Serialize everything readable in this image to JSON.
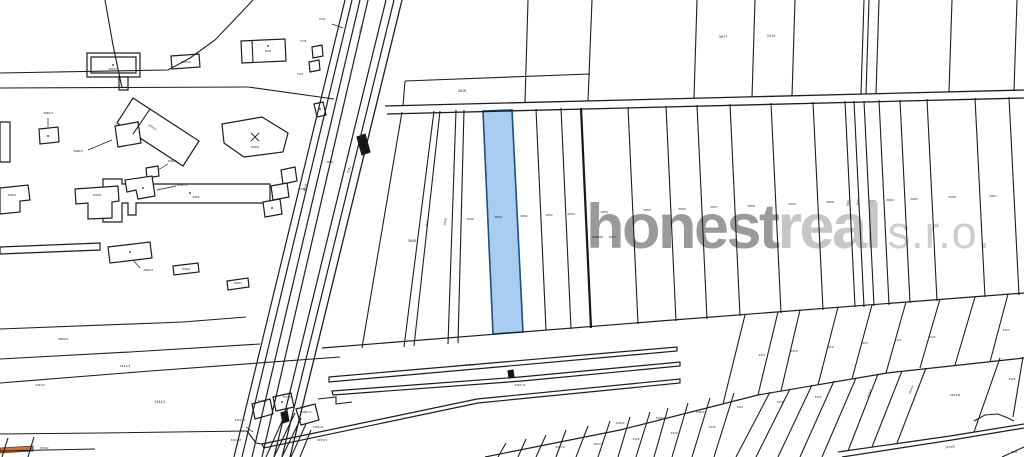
{
  "watermark": {
    "bold_text": "honest",
    "light_text": "real",
    "suffix_text": "s.r.o.",
    "bold_color": "#9a9a9a",
    "light_color": "#c6c6c6",
    "suffix_color": "#cdcdcd"
  },
  "map": {
    "width": 1024,
    "height": 457,
    "background": "#ffffff",
    "line_color": "#1d1d1d",
    "label_color": "#2a2a2a",
    "parcel_fill": "#ffffff",
    "highlight_blue_fill": "#a8cdf0",
    "highlight_blue_stroke": "#1f4e79",
    "highlight_orange_fill": "#c8733a",
    "highlight_orange_stroke": "#6b3410",
    "polygons": [
      {
        "p": "483,111 512,110 523,332 493,334",
        "f": "#a8cdf0",
        "s": "#1f4e79",
        "w": 1.6,
        "n": "highlighted-parcel-blue"
      },
      {
        "p": "0,448 33,446 33,451 0,453",
        "f": "#c8733a",
        "s": "#6b3410",
        "w": 0.8,
        "n": "highlighted-parcel-orange"
      },
      {
        "p": "329,377 677,347 677,351 329,382",
        "n": "railway-strip"
      },
      {
        "p": "332,391 520,377 680,362 680,366 522,381 333,395",
        "n": "railway-strip"
      },
      {
        "p": "262,444 477,399 680,379 680,383 478,403 264,448",
        "n": "railway-strip"
      },
      {
        "p": "357,137 365,134 370,152 362,155",
        "f": "#141414",
        "n": "building-footprint-filled"
      },
      {
        "p": "281,413 287,411 289,421 283,423",
        "f": "#141414",
        "n": "building-footprint-filled"
      },
      {
        "p": "508,371 513,370 514,377 509,378",
        "f": "#141414",
        "n": "building-footprint-filled"
      },
      {
        "p": "314,104 323,102 326,115 317,117",
        "n": "building-outline"
      },
      {
        "p": "252,404 270,399 273,414 255,419",
        "n": "parcel-polygon"
      },
      {
        "p": "273,397 291,393 294,407 276,411",
        "n": "parcel-polygon"
      },
      {
        "p": "296,409 315,404 319,420 301,425",
        "n": "parcel-polygon"
      },
      {
        "p": "87,53 140,53 140,77 87,77",
        "n": "building-outline"
      },
      {
        "p": "91,57 136,57 136,73 91,73",
        "f": "none",
        "n": "building-inner-outline"
      },
      {
        "p": "119,77 128,77 128,90 119,90",
        "n": "building-outline"
      },
      {
        "p": "171,56 199,54 200,67 172,69",
        "n": "building-outline"
      },
      {
        "p": "241,41 285,39 286,61 242,63",
        "n": "building-outline"
      },
      {
        "p": "312,47 322,45 323,56 313,58",
        "n": "building-outline"
      },
      {
        "p": "309,62 319,60 320,70 310,72",
        "n": "building-outline"
      },
      {
        "p": "133,98 199,141 183,166 117,123",
        "n": "building-outline"
      },
      {
        "p": "222,124 262,117 288,133 283,152 244,157 224,143",
        "n": "building-outline"
      },
      {
        "p": "103,179 122,179 122,184 270,184 270,203 136,203 136,215 128,215 128,203 122,203 122,222 103,222",
        "n": "building-outline"
      },
      {
        "p": "0,122 10,122 10,162 0,162",
        "n": "building-outline"
      },
      {
        "p": "39,129 58,127 59,142 40,144",
        "n": "building-outline"
      },
      {
        "p": "115,126 138,122 141,143 118,147",
        "n": "building-outline"
      },
      {
        "p": "146,168 158,166 159,176 147,178",
        "n": "building-outline"
      },
      {
        "p": "125,180 152,176 155,196 138,199 136,190 127,192",
        "n": "building-outline"
      },
      {
        "p": "0,188 28,185 30,200 20,201 20,212 0,214",
        "n": "building-outline"
      },
      {
        "p": "75,189 118,186 119,201 112,202 112,218 88,219 88,203 76,204",
        "n": "building-outline"
      },
      {
        "p": "281,170 295,167 297,181 283,184",
        "n": "building-outline"
      },
      {
        "p": "271,186 287,183 289,197 273,200",
        "n": "building-outline"
      },
      {
        "p": "263,202 280,199 282,214 265,217",
        "n": "building-outline"
      },
      {
        "p": "0,247 100,243 100,250 0,254",
        "n": "building-outline"
      },
      {
        "p": "108,247 150,242 152,258 110,263",
        "n": "building-outline"
      },
      {
        "p": "173,266 198,263 199,272 174,275",
        "n": "building-outline"
      },
      {
        "p": "227,281 248,278 249,287 228,290",
        "n": "building-outline"
      }
    ],
    "lines": [
      {
        "p": "105,0 113,45 122,88"
      },
      {
        "p": "0,88 248,87"
      },
      {
        "p": "248,87 334,99"
      },
      {
        "p": "253,0 236,18 215,40 190,58 168,70 0,73"
      },
      {
        "p": "0,329 183,322 246,317"
      },
      {
        "p": "0,359 130,352 260,344"
      },
      {
        "p": "0,383 150,371 340,357"
      },
      {
        "p": "0,434 100,433 247,431"
      },
      {
        "p": "0,451 95,449"
      },
      {
        "p": "8,438 2,457"
      },
      {
        "p": "34,437 28,457"
      },
      {
        "p": "345,0 234,457",
        "w": 1.2
      },
      {
        "p": "352,0 242,457",
        "w": 1.2
      },
      {
        "p": "360,0 252,457",
        "w": 1.2
      },
      {
        "p": "368,0 262,457",
        "w": 1.2
      },
      {
        "p": "386,0 274,457",
        "w": 1.2
      },
      {
        "p": "394,0 282,457",
        "w": 1.2
      },
      {
        "p": "402,0 290,457",
        "w": 1.3
      },
      {
        "p": "385,106 1024,90",
        "w": 1.3
      },
      {
        "p": "387,114 1024,98",
        "w": 1.3
      },
      {
        "p": "528,0 525,102"
      },
      {
        "p": "592,0 588,101"
      },
      {
        "p": "697,0 694,98"
      },
      {
        "p": "755,0 752,97"
      },
      {
        "p": "795,0 792,96"
      },
      {
        "p": "864,0 861,94"
      },
      {
        "p": "869,0 866,94"
      },
      {
        "p": "879,0 876,94"
      },
      {
        "p": "952,0 949,92"
      },
      {
        "p": "1017,0 1014,90"
      },
      {
        "p": "405,81 590,74"
      },
      {
        "p": "405,81 403,106"
      },
      {
        "p": "322,348 660,321 1024,293",
        "w": 1.2
      },
      {
        "p": "402,112 362,348"
      },
      {
        "p": "434,111 404,347"
      },
      {
        "p": "440,111 414,346"
      },
      {
        "p": "456,110 448,344"
      },
      {
        "p": "464,110 458,343"
      },
      {
        "p": "536,109 546,330"
      },
      {
        "p": "561,108 571,329"
      },
      {
        "p": "581,108 591,328",
        "w": 2.2,
        "c": "#101820"
      },
      {
        "p": "628,107 638,324"
      },
      {
        "p": "666,106 676,321"
      },
      {
        "p": "697,105 707,319"
      },
      {
        "p": "730,104 740,316"
      },
      {
        "p": "771,103 781,313"
      },
      {
        "p": "813,102 823,310"
      },
      {
        "p": "845,101 855,307"
      },
      {
        "p": "854,101 864,307"
      },
      {
        "p": "864,101 874,306"
      },
      {
        "p": "879,100 889,305"
      },
      {
        "p": "900,100 910,303"
      },
      {
        "p": "927,99 937,301"
      },
      {
        "p": "975,98 985,297"
      },
      {
        "p": "1009,97 1019,295"
      },
      {
        "p": "745,315 723,404"
      },
      {
        "p": "778,312 758,395"
      },
      {
        "p": "800,310 781,391"
      },
      {
        "p": "838,307 818,385"
      },
      {
        "p": "872,305 852,379"
      },
      {
        "p": "906,302 886,373"
      },
      {
        "p": "940,299 920,368"
      },
      {
        "p": "975,297 955,365"
      },
      {
        "p": "1008,294 990,362"
      },
      {
        "p": "485,457 620,430 758,395 887,373 1024,358",
        "w": 1.2
      },
      {
        "p": "506,443 498,457"
      },
      {
        "p": "526,439 518,457"
      },
      {
        "p": "546,435 536,457"
      },
      {
        "p": "566,430 556,457"
      },
      {
        "p": "588,426 576,457"
      },
      {
        "p": "610,421 598,457"
      },
      {
        "p": "630,417 618,457"
      },
      {
        "p": "650,412 636,457"
      },
      {
        "p": "668,408 654,457"
      },
      {
        "p": "688,403 672,457"
      },
      {
        "p": "710,398 692,457"
      },
      {
        "p": "734,393 714,457"
      },
      {
        "p": "770,392 736,457"
      },
      {
        "p": "790,389 756,457"
      },
      {
        "p": "812,385 778,457"
      },
      {
        "p": "834,381 800,457"
      },
      {
        "p": "856,378 822,457"
      },
      {
        "p": "878,374 848,451"
      },
      {
        "p": "902,371 872,447"
      },
      {
        "p": "926,368 897,443"
      },
      {
        "p": "1000,358 974,432"
      },
      {
        "p": "1023,357 1013,417"
      },
      {
        "p": "974,421 985,415 998,414 1008,418 1014,421",
        "w": 1.0
      },
      {
        "p": "838,452 950,436 1024,424",
        "w": 1.2
      },
      {
        "p": "842,457 952,440 1024,428",
        "w": 1.2
      },
      {
        "p": "1002,457 1024,447"
      },
      {
        "p": "288,408 266,457"
      },
      {
        "p": "295,413 274,457"
      },
      {
        "p": "301,418 282,457"
      },
      {
        "p": "306,424 291,457"
      },
      {
        "p": "311,430 300,457"
      },
      {
        "p": "318,399 336,397 336,404 352,402"
      },
      {
        "p": "247,431 256,443 262,444"
      },
      {
        "p": "252,41 253,62"
      },
      {
        "p": "150,109 133,134"
      },
      {
        "p": "251,133 259,141",
        "w": 0.9
      },
      {
        "p": "259,133 251,141",
        "w": 0.9
      },
      {
        "p": "246,427 253,432",
        "w": 0.7,
        "n": "leader-arrow"
      },
      {
        "p": "592,237 603,237",
        "w": 0.7,
        "n": "leader-arrow"
      },
      {
        "p": "48,118 48,127",
        "w": 0.7,
        "n": "leader-arrow"
      },
      {
        "p": "88,150 112,140",
        "w": 0.7,
        "n": "leader-arrow"
      },
      {
        "p": "168,164 158,170",
        "w": 0.7,
        "n": "leader-arrow"
      },
      {
        "p": "176,186 157,190",
        "w": 0.7,
        "n": "leader-arrow"
      },
      {
        "p": "140,268 133,260",
        "w": 0.7,
        "n": "leader-arrow"
      },
      {
        "p": "332,24 343,28",
        "w": 0.7,
        "n": "leader-arrow"
      }
    ],
    "dots": [
      [
        113,
        65
      ],
      [
        268,
        46
      ],
      [
        138,
        122
      ],
      [
        190,
        193
      ],
      [
        48,
        136
      ],
      [
        130,
        252
      ],
      [
        143,
        188
      ],
      [
        272,
        208
      ],
      [
        320,
        109
      ],
      [
        282,
        402
      ]
    ],
    "labels": [
      [
        462,
        92,
        "3616",
        3.4
      ],
      [
        723,
        38,
        "3677",
        3.4
      ],
      [
        771,
        37,
        "3319",
        3.4
      ],
      [
        350,
        170,
        "7541",
        3,
        -75
      ],
      [
        306,
        188,
        "3614",
        3,
        -75
      ],
      [
        362,
        30,
        "7540",
        3,
        -75
      ],
      [
        322,
        20,
        "7539",
        2.5
      ],
      [
        330,
        163,
        "2801",
        3
      ],
      [
        412,
        242,
        "3646",
        3.4
      ],
      [
        428,
        224,
        "3647",
        2.8,
        -80
      ],
      [
        446,
        222,
        "3648",
        2.8,
        -80
      ],
      [
        470,
        220,
        "3649",
        3
      ],
      [
        498,
        218,
        "3650",
        3
      ],
      [
        524,
        217,
        "3651",
        3
      ],
      [
        549,
        216,
        "3652",
        3
      ],
      [
        571,
        215,
        "3653",
        3
      ],
      [
        604,
        213,
        "3654",
        3
      ],
      [
        647,
        211,
        "3655",
        3
      ],
      [
        682,
        210,
        "3656",
        3
      ],
      [
        714,
        208,
        "3657",
        3
      ],
      [
        751,
        207,
        "3658",
        3
      ],
      [
        792,
        205,
        "3659",
        3
      ],
      [
        830,
        203,
        "3660",
        3
      ],
      [
        849,
        203,
        "3661",
        2.8,
        -80
      ],
      [
        859,
        202,
        "3662",
        2.8,
        -80
      ],
      [
        872,
        202,
        "3663",
        3
      ],
      [
        890,
        201,
        "3664",
        3
      ],
      [
        914,
        200,
        "3665",
        3
      ],
      [
        952,
        198,
        "3666",
        3
      ],
      [
        993,
        197,
        "3667",
        3
      ],
      [
        612,
        238,
        "3653",
        2.8
      ],
      [
        762,
        356,
        "3417",
        2.8
      ],
      [
        794,
        352,
        "3418",
        2.8
      ],
      [
        830,
        348,
        "3419",
        2.8
      ],
      [
        864,
        344,
        "3420",
        2.8
      ],
      [
        898,
        341,
        "3421",
        2.8
      ],
      [
        932,
        338,
        "3422",
        2.8
      ],
      [
        1006,
        331,
        "3423",
        2.8
      ],
      [
        560,
        448,
        "3427/2",
        2.8
      ],
      [
        598,
        445,
        "3427/5",
        2.8
      ],
      [
        636,
        440,
        "3428",
        2.8
      ],
      [
        674,
        434,
        "3429",
        2.8
      ],
      [
        712,
        428,
        "3430",
        2.8
      ],
      [
        620,
        424,
        "3428/4",
        2.6
      ],
      [
        660,
        419,
        "3429/3",
        2.6
      ],
      [
        700,
        413,
        "3430/2",
        2.6
      ],
      [
        740,
        408,
        "3431",
        2.6
      ],
      [
        780,
        403,
        "3432",
        2.6
      ],
      [
        818,
        398,
        "3433",
        2.6
      ],
      [
        870,
        394,
        "3425/1",
        2.6,
        -70
      ],
      [
        912,
        390,
        "3424/4",
        2.6,
        -70
      ],
      [
        955,
        396,
        "3424/8",
        3
      ],
      [
        1012,
        380,
        "3426",
        2.8
      ],
      [
        950,
        448,
        "3478/8",
        2.8,
        -8
      ],
      [
        1014,
        453,
        "3130",
        2.6
      ],
      [
        470,
        366,
        "3467/1",
        2.8
      ],
      [
        520,
        386,
        "3467/11",
        2.8
      ],
      [
        240,
        421,
        "3441/31",
        2.6
      ],
      [
        236,
        441,
        "3441/33",
        2.6
      ],
      [
        262,
        402,
        "7541/3",
        2.6
      ],
      [
        287,
        398,
        "7541/4",
        2.6
      ],
      [
        306,
        413,
        "3466/13",
        2.6
      ],
      [
        318,
        428,
        "3466/14",
        2.6
      ],
      [
        63,
        340,
        "3680/2",
        3
      ],
      [
        125,
        367,
        "3441/3",
        3
      ],
      [
        40,
        386,
        "3441/5",
        2.8
      ],
      [
        160,
        403,
        "3441/1",
        3.2
      ],
      [
        322,
        441,
        "3453/1",
        3
      ],
      [
        44,
        449,
        "3453/2",
        2.6
      ],
      [
        148,
        271,
        "3680/8",
        2.8
      ],
      [
        186,
        270,
        "3680/6",
        2.4
      ],
      [
        238,
        284,
        "3680/7",
        2.4
      ],
      [
        113,
        70,
        "2805/7",
        2.6
      ],
      [
        186,
        63,
        "2805/9",
        2.5
      ],
      [
        268,
        52,
        "2806",
        2.5
      ],
      [
        303,
        42,
        "7538",
        2.5
      ],
      [
        300,
        75,
        "7539",
        2.5
      ],
      [
        152,
        128,
        "2804/1",
        2.6,
        33
      ],
      [
        255,
        148,
        "2806/2",
        2.5
      ],
      [
        196,
        198,
        "2802",
        2.8
      ],
      [
        48,
        114,
        "3680/3",
        2.8
      ],
      [
        78,
        152,
        "3680/5",
        2.8
      ],
      [
        172,
        162,
        "3680/9",
        2.6
      ],
      [
        182,
        186,
        "3680/11",
        2.6
      ],
      [
        12,
        196,
        "2800/1",
        2.5
      ],
      [
        97,
        196,
        "2800/4",
        2.5
      ],
      [
        302,
        190,
        "7536",
        2.5
      ]
    ]
  }
}
